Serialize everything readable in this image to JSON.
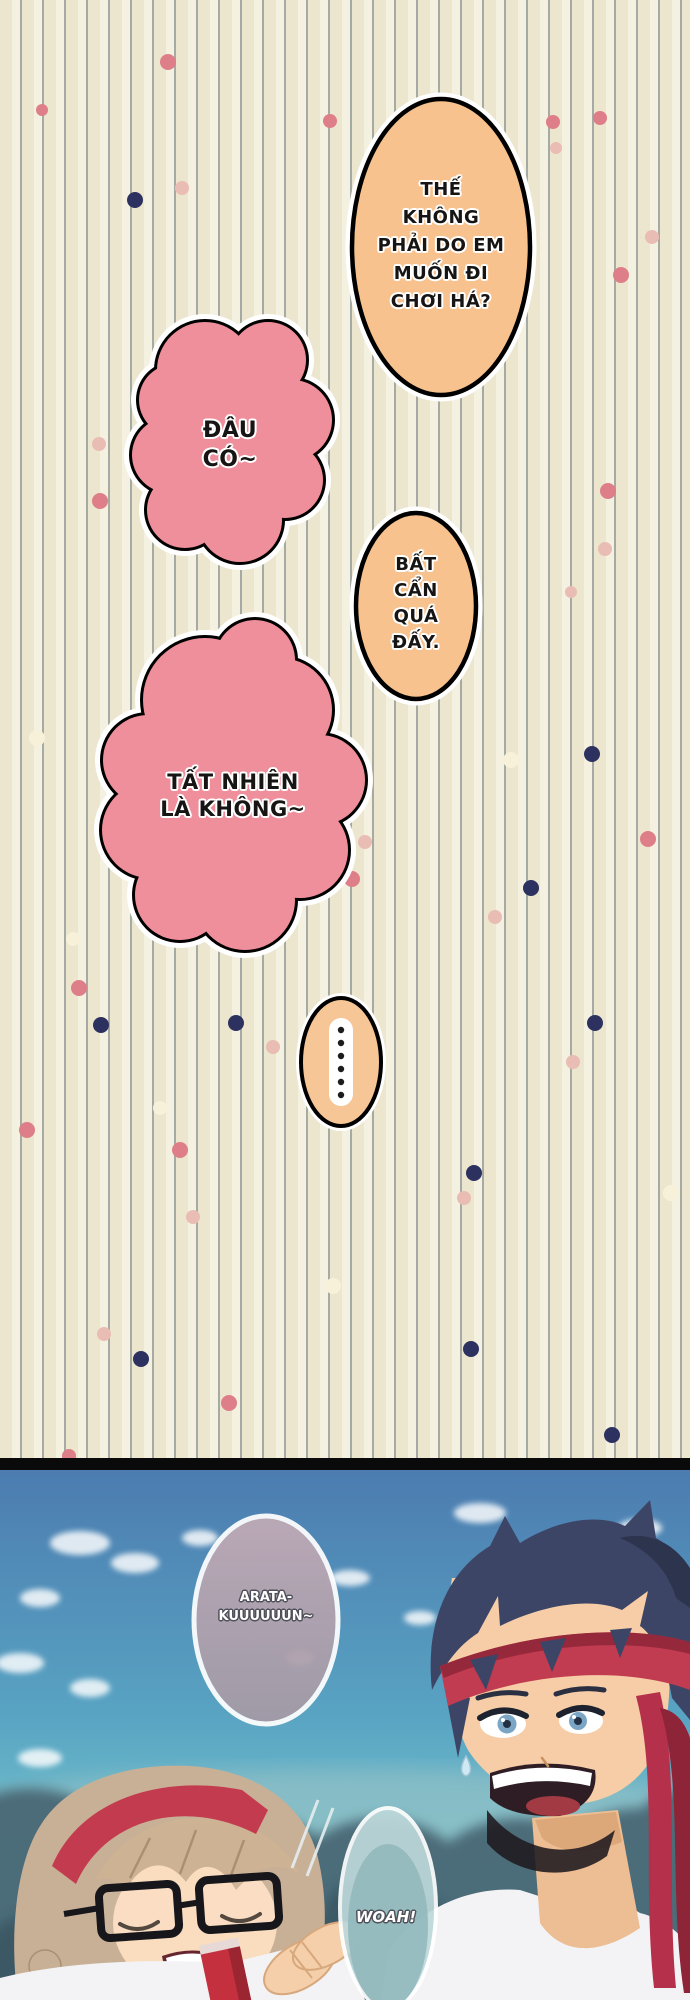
{
  "page": {
    "background_color": "#ece6ce",
    "stripe_color": "#a6aaa4",
    "divider_color": "#0a0a0a"
  },
  "bubbles": {
    "b1": {
      "shape": "ellipse",
      "fill": "#f7c28e",
      "lines": [
        "THẾ",
        "KHÔNG",
        "PHẢI DO EM",
        "MUỐN ĐI",
        "CHƠI HÁ?"
      ]
    },
    "b2": {
      "shape": "cloud",
      "fill": "#ef8f9b",
      "lines": [
        "ĐÂU",
        "CÓ~"
      ]
    },
    "b3": {
      "shape": "ellipse",
      "fill": "#f7c28e",
      "lines": [
        "BẤT",
        "CẨN",
        "QUÁ",
        "ĐẤY."
      ]
    },
    "b4": {
      "shape": "cloud",
      "fill": "#ef8f9b",
      "lines": [
        "TẤT NHIÊN",
        "LÀ KHÔNG~"
      ]
    },
    "ellipsis": {
      "shape": "ellipse",
      "fill": "#f6c697",
      "dot_count": 6,
      "dot_color": "#1c1c1c"
    },
    "arata": {
      "shape": "egg",
      "fill": "#b3a2ae",
      "lines": [
        "ARATA-",
        "KUUUUUUN~"
      ]
    },
    "woah": {
      "shape": "pill",
      "fill": "#bdd8da",
      "lines": [
        "WOAH!"
      ]
    }
  },
  "dot_palette": {
    "rose": "#dd7e88",
    "pale_pink": "#e9bdb4",
    "navy": "#2c3160",
    "cream": "#f8f1d9"
  },
  "dots": [
    [
      168,
      62,
      8,
      "rose"
    ],
    [
      42,
      110,
      6,
      "rose"
    ],
    [
      330,
      121,
      7,
      "rose"
    ],
    [
      600,
      118,
      7,
      "rose"
    ],
    [
      553,
      122,
      7,
      "rose"
    ],
    [
      621,
      275,
      8,
      "rose"
    ],
    [
      100,
      501,
      8,
      "rose"
    ],
    [
      608,
      491,
      8,
      "rose"
    ],
    [
      392,
      557,
      7,
      "rose"
    ],
    [
      352,
      879,
      8,
      "rose"
    ],
    [
      648,
      839,
      8,
      "rose"
    ],
    [
      79,
      988,
      8,
      "rose"
    ],
    [
      27,
      1130,
      8,
      "rose"
    ],
    [
      180,
      1150,
      8,
      "rose"
    ],
    [
      229,
      1403,
      8,
      "rose"
    ],
    [
      69,
      1456,
      7,
      "rose"
    ],
    [
      182,
      188,
      7,
      "pale_pink"
    ],
    [
      556,
      148,
      6,
      "pale_pink"
    ],
    [
      652,
      237,
      7,
      "pale_pink"
    ],
    [
      99,
      444,
      7,
      "pale_pink"
    ],
    [
      605,
      549,
      7,
      "pale_pink"
    ],
    [
      571,
      592,
      6,
      "pale_pink"
    ],
    [
      365,
      842,
      7,
      "pale_pink"
    ],
    [
      495,
      917,
      7,
      "pale_pink"
    ],
    [
      273,
      1047,
      7,
      "pale_pink"
    ],
    [
      573,
      1062,
      7,
      "pale_pink"
    ],
    [
      193,
      1217,
      7,
      "pale_pink"
    ],
    [
      464,
      1198,
      7,
      "pale_pink"
    ],
    [
      104,
      1334,
      7,
      "pale_pink"
    ],
    [
      135,
      200,
      8,
      "navy"
    ],
    [
      592,
      754,
      8,
      "navy"
    ],
    [
      531,
      888,
      8,
      "navy"
    ],
    [
      101,
      1025,
      8,
      "navy"
    ],
    [
      236,
      1023,
      8,
      "navy"
    ],
    [
      595,
      1023,
      8,
      "navy"
    ],
    [
      474,
      1173,
      8,
      "navy"
    ],
    [
      141,
      1359,
      8,
      "navy"
    ],
    [
      471,
      1349,
      8,
      "navy"
    ],
    [
      612,
      1435,
      8,
      "navy"
    ],
    [
      37,
      738,
      8,
      "cream"
    ],
    [
      511,
      760,
      8,
      "cream"
    ],
    [
      130,
      827,
      7,
      "cream"
    ],
    [
      73,
      939,
      7,
      "cream"
    ],
    [
      160,
      1108,
      7,
      "cream"
    ],
    [
      333,
      1286,
      8,
      "cream"
    ],
    [
      671,
      1193,
      8,
      "cream"
    ]
  ],
  "scene": {
    "sky_top": "#4c7cb0",
    "sky_mid": "#58a2c2",
    "sky_bottom": "#85d3d8",
    "tree_color": "#4a6874",
    "boy_hair": "#3d4566",
    "headband": "#c13c50",
    "girl_hair": "#c8b097",
    "hairband": "#c33b4f",
    "skin": "#f6cda6",
    "shirt": "#f3f3f5"
  }
}
